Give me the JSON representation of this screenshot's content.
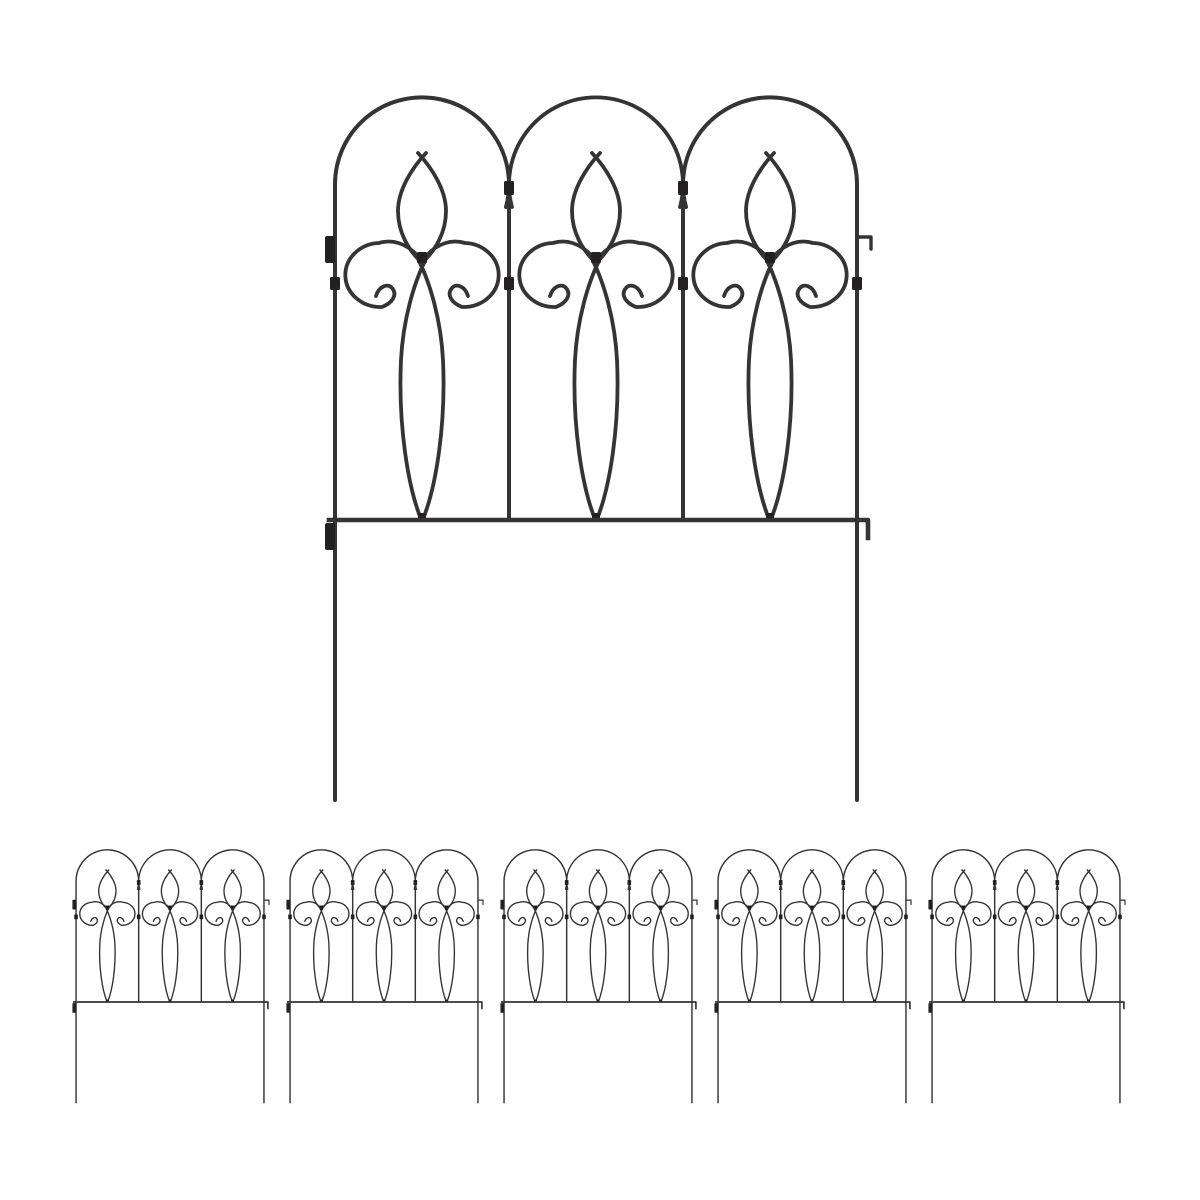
{
  "canvas": {
    "width": 1200,
    "height": 1200,
    "background": "#ffffff"
  },
  "product": {
    "name": "decorative-metal-garden-border-fence",
    "description": "Black wrought-iron style folding garden edging fence panels with triple arches, scrollwork, pointed oval ornaments, bottom rail and ground stakes",
    "wire_color": "#363334",
    "joint_color": "#232021",
    "panel_count": 6,
    "large_panel_count": 1,
    "small_panel_count": 5
  },
  "scene": {
    "large_panel": {
      "x": 323,
      "y": 95,
      "width": 551,
      "height": 710
    },
    "small_panels": [
      {
        "x": 71.7,
        "y": 849,
        "width": 198.4,
        "height": 255.6
      },
      {
        "x": 285.7,
        "y": 849,
        "width": 198.4,
        "height": 255.6
      },
      {
        "x": 499.7,
        "y": 849,
        "width": 198.4,
        "height": 255.6
      },
      {
        "x": 713.7,
        "y": 849,
        "width": 198.4,
        "height": 255.6
      },
      {
        "x": 927.7,
        "y": 849,
        "width": 198.4,
        "height": 255.6
      }
    ]
  }
}
